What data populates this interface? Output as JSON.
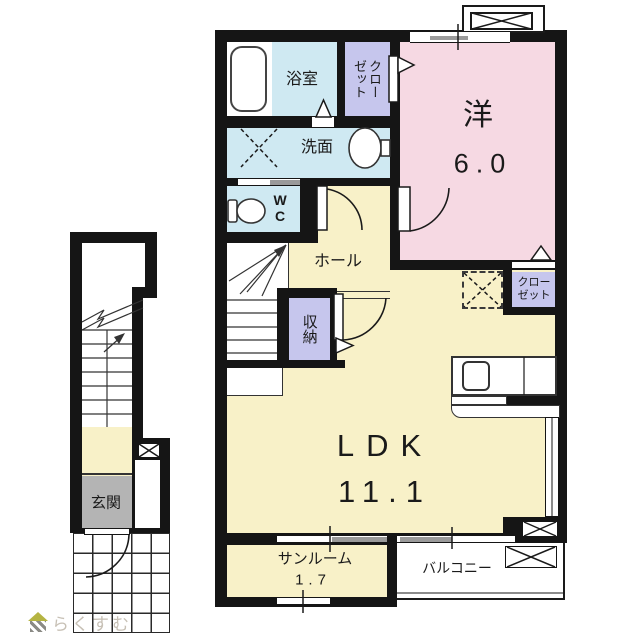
{
  "watermark": {
    "brand": "らくすむ"
  },
  "rooms": {
    "bathroom": {
      "label": "浴室"
    },
    "closet_top": {
      "lines": [
        "クロー",
        "ゼット"
      ]
    },
    "western": {
      "label": "洋",
      "size": "6.0"
    },
    "washroom": {
      "label": "洗面"
    },
    "wc": {
      "label": "WC"
    },
    "hall": {
      "label": "ホール"
    },
    "storage": {
      "label": "収納"
    },
    "closet_ldk": {
      "lines": [
        "クロー",
        "ゼット"
      ]
    },
    "ldk": {
      "label": "LDK",
      "size": "11.1"
    },
    "sunroom": {
      "label": "サンルーム",
      "size": "1.7"
    },
    "balcony": {
      "label": "バルコニー"
    },
    "entrance": {
      "label": "玄関"
    }
  },
  "colors": {
    "wall": "#151515",
    "cream": "#f8f1c8",
    "pink": "#f6d9e3",
    "blue": "#cfe9f2",
    "purple": "#c6c6ed",
    "entrance_gray": "#b4b4b4",
    "track_gray": "#9a9a9a",
    "watermark": "#c7c0b5",
    "logo_olive": "#b5b442"
  }
}
